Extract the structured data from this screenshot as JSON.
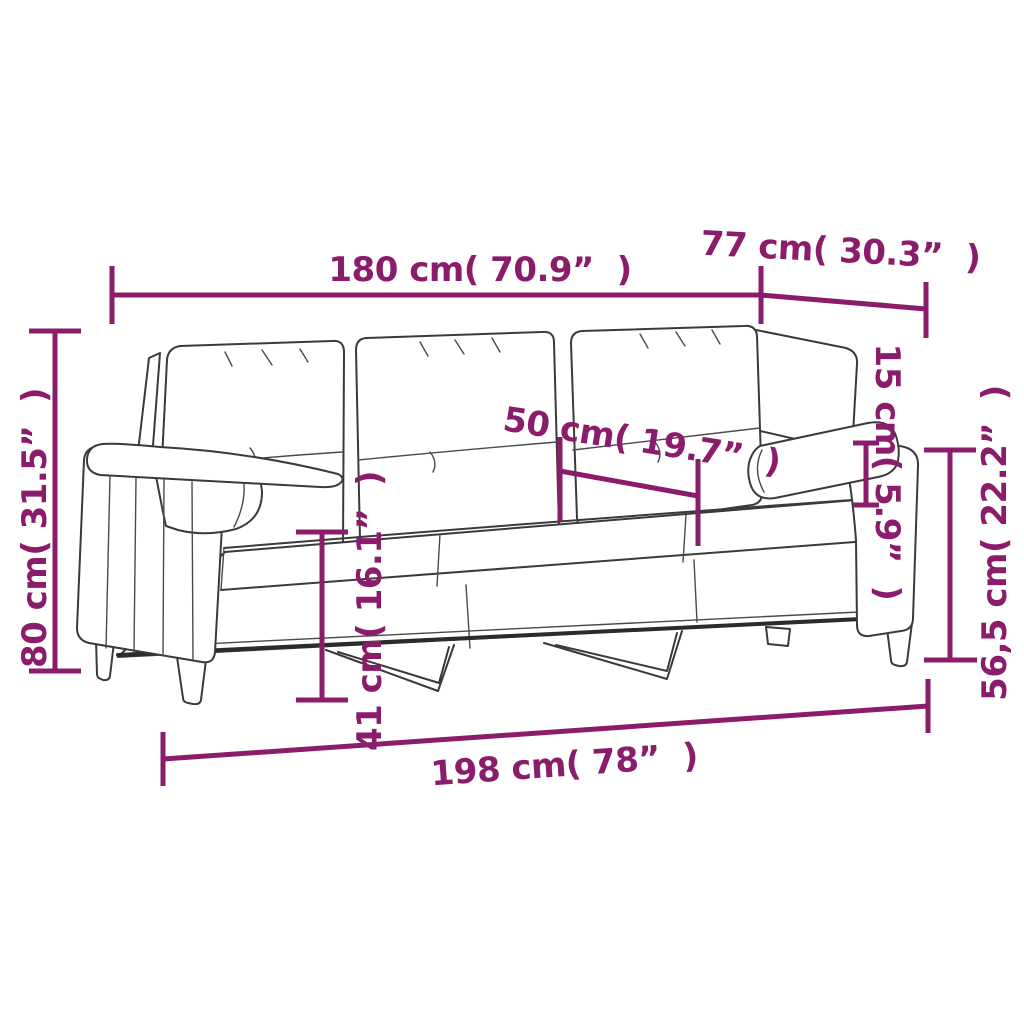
{
  "colors": {
    "accent": "#8a1c6b",
    "outline": "#3a3a3a",
    "background": "#ffffff"
  },
  "diagram": {
    "subject": "three-seat-sofa-line-drawing",
    "dimensions": {
      "width_top": {
        "label": "180 cm( 70.9”  )",
        "value": "180",
        "unit": "cm",
        "inches": "70.9"
      },
      "depth_top": {
        "label": "77 cm( 30.3”  )",
        "value": "77",
        "unit": "cm",
        "inches": "30.3"
      },
      "back_height_left": {
        "label": "80 cm( 31.5”  )",
        "value": "80",
        "unit": "cm",
        "inches": "31.5"
      },
      "seat_depth": {
        "label": "50 cm( 19.7”  )",
        "value": "50",
        "unit": "cm",
        "inches": "19.7"
      },
      "bolster_diameter": {
        "label": "15 cm( 5.9”  )",
        "value": "15",
        "unit": "cm",
        "inches": "5.9"
      },
      "arm_height_right": {
        "label": "56,5 cm( 22.2”  )",
        "value": "56,5",
        "unit": "cm",
        "inches": "22.2"
      },
      "seat_height": {
        "label": "41 cm( 16.1”  )",
        "value": "41",
        "unit": "cm",
        "inches": "16.1"
      },
      "total_length_bottom": {
        "label": "198 cm( 78”  )",
        "value": "198",
        "unit": "cm",
        "inches": "78"
      }
    }
  }
}
